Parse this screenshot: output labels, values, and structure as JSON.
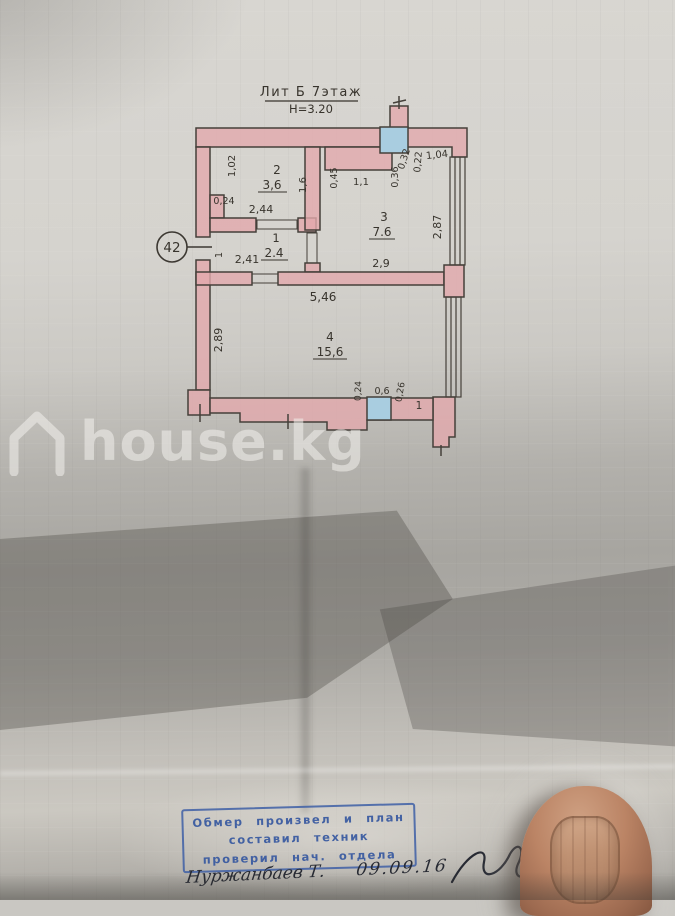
{
  "plan": {
    "title": "Лит Б 7этаж",
    "height_note": "Н=3.20",
    "unit": "42",
    "rooms": [
      {
        "num": "1",
        "area": "2.4"
      },
      {
        "num": "2",
        "area": "3,6"
      },
      {
        "num": "3",
        "area": "7.6"
      },
      {
        "num": "4",
        "area": "15,6"
      }
    ],
    "labels": {
      "r2_left": "1,02",
      "r2_step": "0,24",
      "r2_bottom": "2,44",
      "r2_right": "1,6",
      "r1_width": "2,41",
      "r1_door": "1",
      "r3_niche_h": "0,45",
      "r3_niche_w": "1,1",
      "r3_v36": "0,36",
      "r3_v32": "0,32",
      "r3_v22": "0,22",
      "r3_v104": "1,04",
      "r3_right": "2,87",
      "r3_bottom": "2,9",
      "r4_top": "5,46",
      "r4_left": "2,89",
      "r4_b24": "0,24",
      "r4_b06": "0,6",
      "r4_b26": "0,26",
      "r4_b1": "1"
    }
  },
  "watermark": {
    "text": "house.kg",
    "icon": "house-outline"
  },
  "stamp": {
    "line1": "Обмер произвел и план",
    "line2": "составил техник",
    "line3": "проверил нач. отдела"
  },
  "signature": {
    "name": "Нуржанбаев Т.",
    "date": "09.09.16"
  },
  "colors": {
    "wall_fill": "#e2a9ad",
    "plan_line": "#45403a",
    "shaft_blue": "#a9cde0",
    "stamp_blue": "#3e5fa6",
    "ink": "#272a33",
    "watermark_white": "rgba(243,241,236,0.55)",
    "paper_light": "#d5d3ce",
    "paper_dark": "#95938d"
  }
}
